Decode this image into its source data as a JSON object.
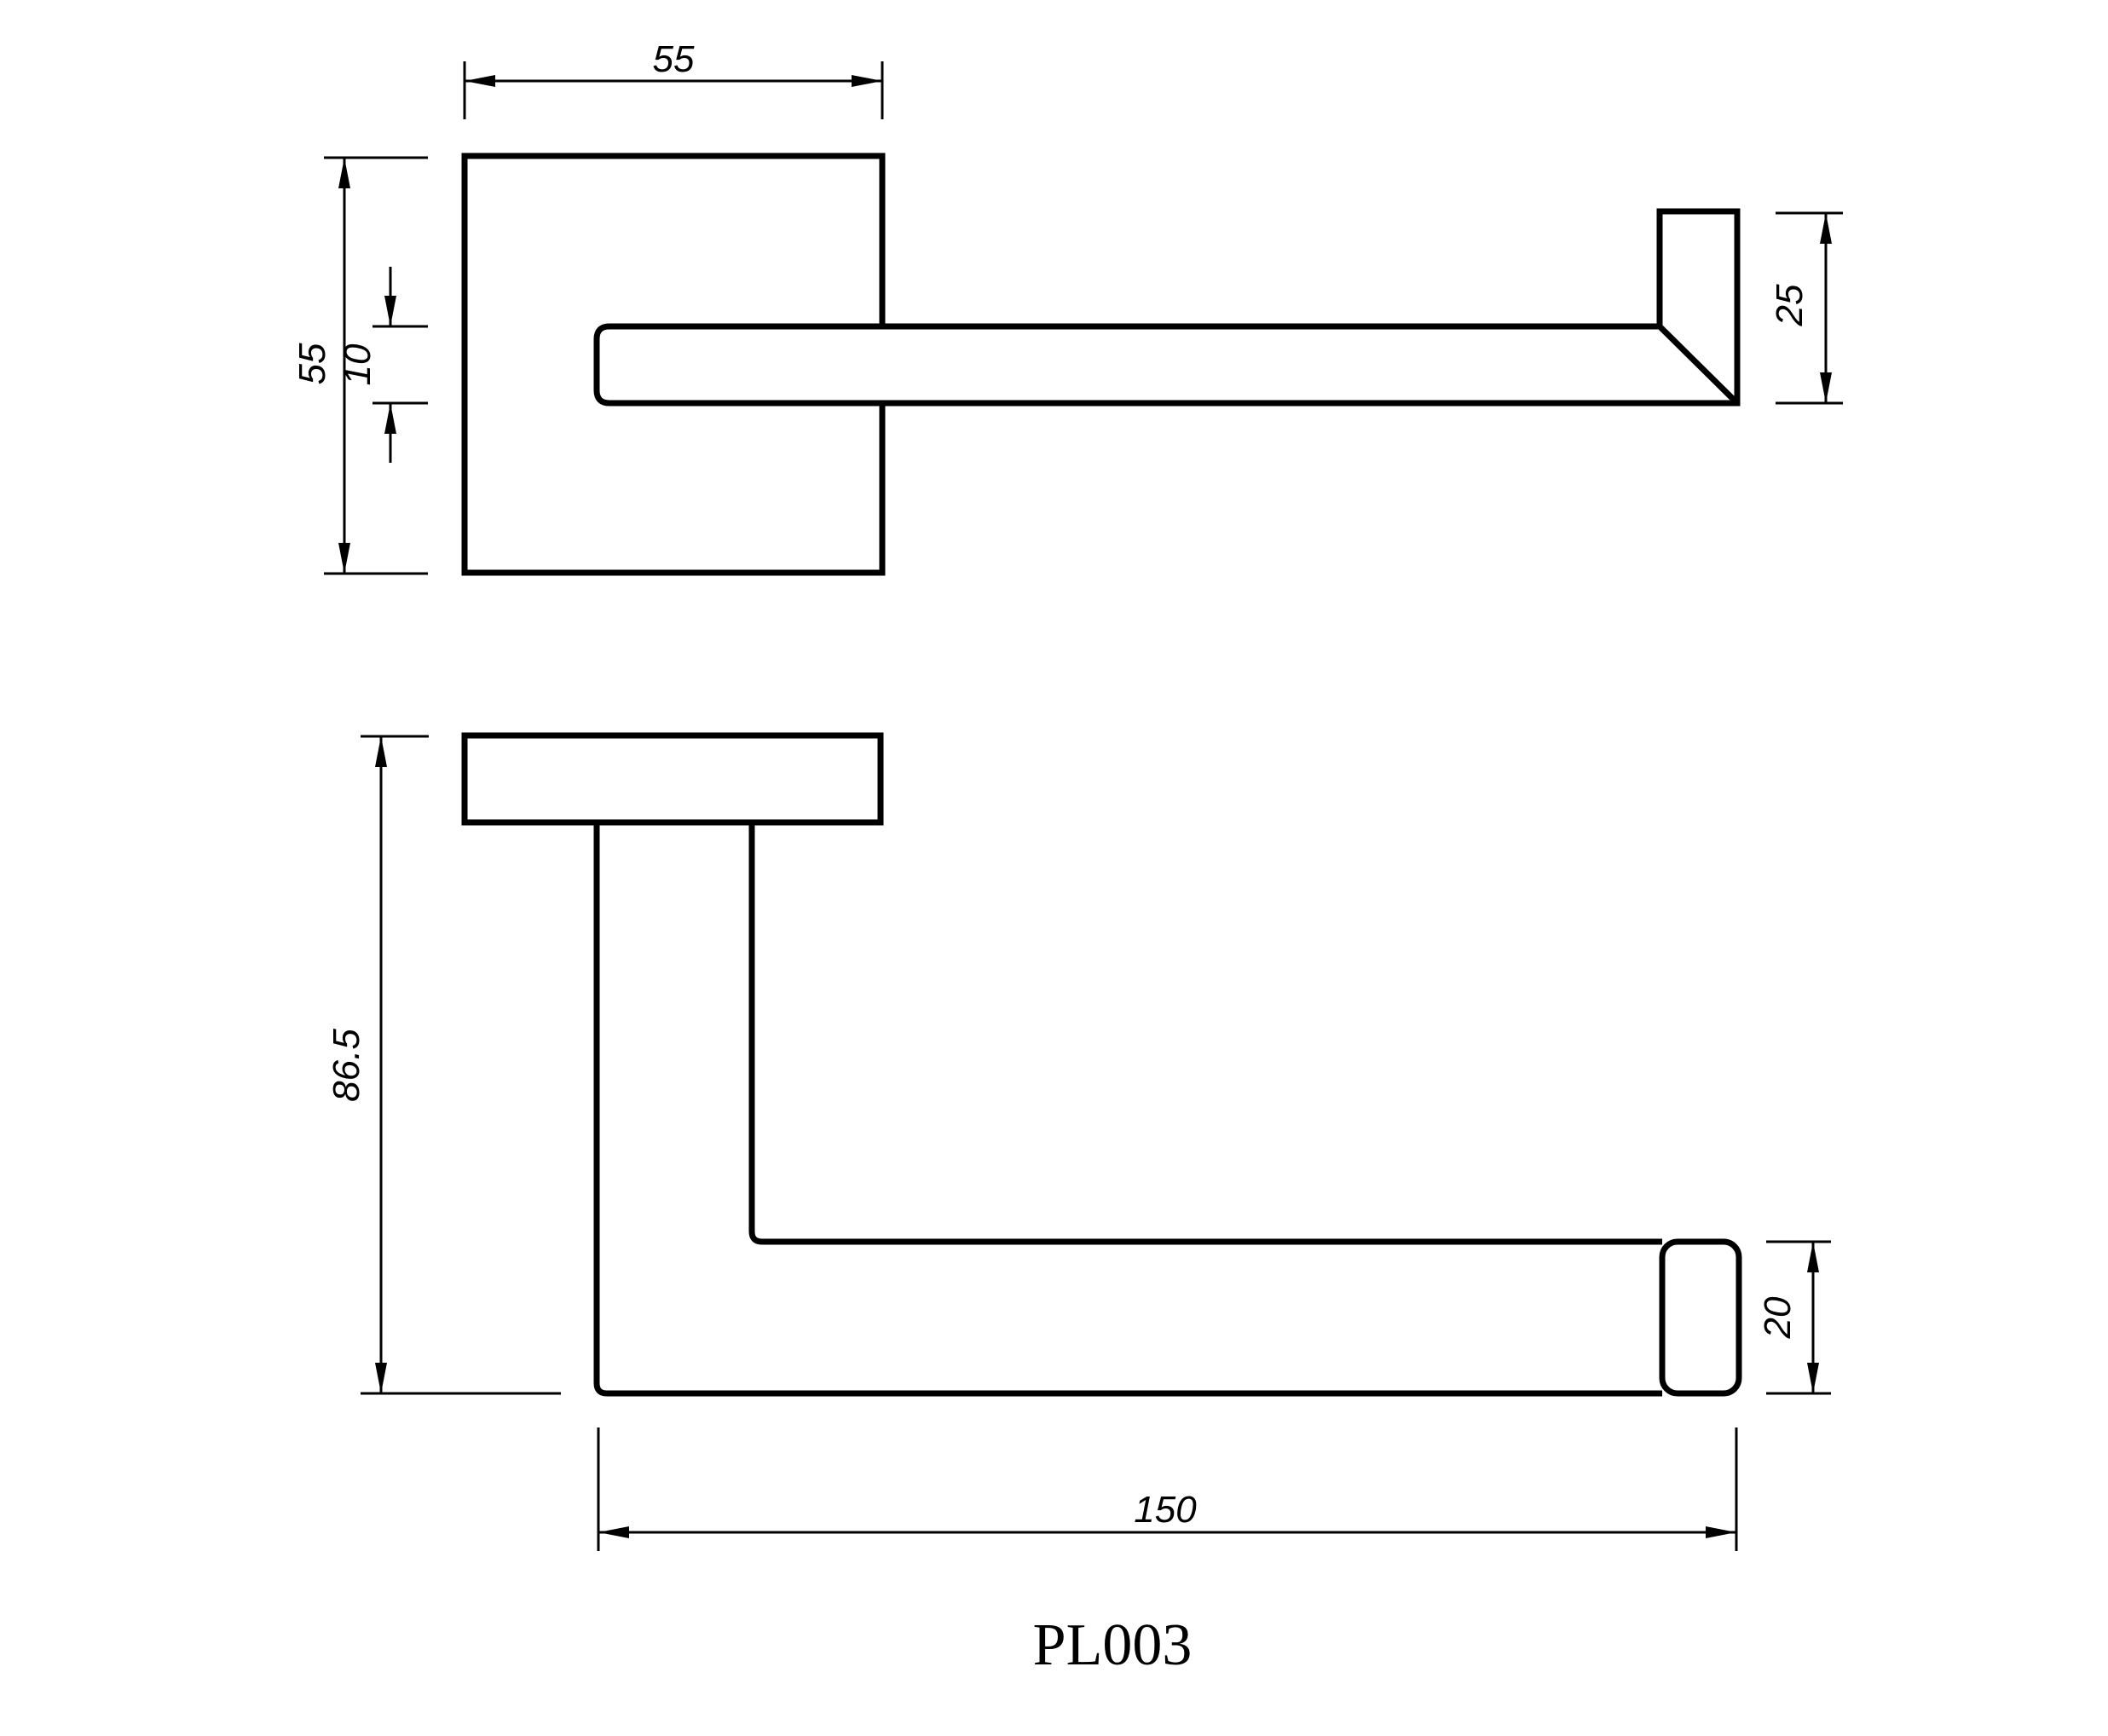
{
  "drawing": {
    "part_number": "PL003",
    "type": "engineering-dimension-drawing",
    "colors": {
      "line": "#000000",
      "background": "#ffffff"
    },
    "dims": {
      "plate_width": "55",
      "plate_height": "55",
      "bar_thickness": "10",
      "end_height": "25",
      "overall_height": "86.5",
      "end_thickness": "20",
      "length": "150"
    }
  }
}
